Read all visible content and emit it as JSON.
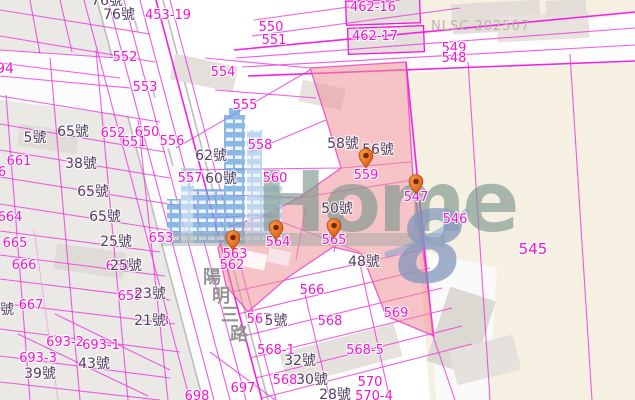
{
  "watermark": {
    "nlsc": "NLSC 202507",
    "logo_text": "Home",
    "logo_numeral": "8"
  },
  "road": {
    "name": "陽明三路"
  },
  "colors": {
    "parcel_label": "#ef16cf",
    "house_label": "#514060",
    "highlight_pink": "#ef9298",
    "boundary_magenta": "#e837dd",
    "pin_orange": "#e05c12",
    "watermark_green": "#7d978e",
    "watermark_blue": "#7e93bb",
    "cream_parcel": "#f6f0e2"
  },
  "map": {
    "parcel_labels": [
      {
        "text": "453-19",
        "x": 168,
        "y": 19
      },
      {
        "text": "550",
        "x": 271,
        "y": 31
      },
      {
        "text": "551",
        "x": 274,
        "y": 44
      },
      {
        "text": "462-16",
        "x": 373,
        "y": 11
      },
      {
        "text": "462-17",
        "x": 375,
        "y": 40
      },
      {
        "text": "549",
        "x": 454,
        "y": 52
      },
      {
        "text": "548",
        "x": 454,
        "y": 62
      },
      {
        "text": "552",
        "x": 125,
        "y": 61
      },
      {
        "text": "553",
        "x": 145,
        "y": 91
      },
      {
        "text": "554",
        "x": 223,
        "y": 76
      },
      {
        "text": "555",
        "x": 245,
        "y": 109
      },
      {
        "text": "556",
        "x": 172,
        "y": 145
      },
      {
        "text": "557",
        "x": 190,
        "y": 182
      },
      {
        "text": "558",
        "x": 260,
        "y": 149
      },
      {
        "text": "560",
        "x": 275,
        "y": 182
      },
      {
        "text": "559",
        "x": 366,
        "y": 179
      },
      {
        "text": "547",
        "x": 416,
        "y": 201
      },
      {
        "text": "546",
        "x": 455,
        "y": 223
      },
      {
        "text": "545",
        "x": 533,
        "y": 254,
        "size": 15
      },
      {
        "text": "562",
        "x": 232,
        "y": 269
      },
      {
        "text": "563",
        "x": 235,
        "y": 258
      },
      {
        "text": "564",
        "x": 278,
        "y": 246
      },
      {
        "text": "565",
        "x": 334,
        "y": 244
      },
      {
        "text": "566",
        "x": 312,
        "y": 294
      },
      {
        "text": "567",
        "x": 259,
        "y": 323
      },
      {
        "text": "568",
        "x": 330,
        "y": 325
      },
      {
        "text": "569",
        "x": 396,
        "y": 317
      },
      {
        "text": "568-1",
        "x": 276,
        "y": 354
      },
      {
        "text": "568-5",
        "x": 365,
        "y": 354
      },
      {
        "text": "568",
        "x": 285,
        "y": 384
      },
      {
        "text": "570",
        "x": 370,
        "y": 386
      },
      {
        "text": "570-4",
        "x": 374,
        "y": 400
      },
      {
        "text": "697",
        "x": 243,
        "y": 392
      },
      {
        "text": "698",
        "x": 197,
        "y": 400
      },
      {
        "text": "693-2",
        "x": 65,
        "y": 346
      },
      {
        "text": "693-1",
        "x": 101,
        "y": 349
      },
      {
        "text": "693-3",
        "x": 38,
        "y": 362
      },
      {
        "text": "650",
        "x": 147,
        "y": 136
      },
      {
        "text": "651",
        "x": 134,
        "y": 146
      },
      {
        "text": "652",
        "x": 113,
        "y": 137
      },
      {
        "text": "653",
        "x": 161,
        "y": 242
      },
      {
        "text": "654",
        "x": 118,
        "y": 270
      },
      {
        "text": "655",
        "x": 130,
        "y": 300
      },
      {
        "text": "661",
        "x": 19,
        "y": 165
      },
      {
        "text": "664",
        "x": 10,
        "y": 221
      },
      {
        "text": "665",
        "x": 15,
        "y": 247
      },
      {
        "text": "666",
        "x": 24,
        "y": 269
      },
      {
        "text": "667",
        "x": 31,
        "y": 309
      },
      {
        "text": "94",
        "x": 5,
        "y": 73,
        "size": 14
      },
      {
        "text": "6",
        "x": 2,
        "y": 176
      },
      {
        "text": "3",
        "x": 165,
        "y": 325
      }
    ],
    "house_labels": [
      {
        "text": "76號",
        "x": 107,
        "y": 5
      },
      {
        "text": "76號",
        "x": 119,
        "y": 19
      },
      {
        "text": "5號",
        "x": 35,
        "y": 142
      },
      {
        "text": "65號",
        "x": 73,
        "y": 136
      },
      {
        "text": "38號",
        "x": 81,
        "y": 168
      },
      {
        "text": "65號",
        "x": 93,
        "y": 196
      },
      {
        "text": "65號",
        "x": 105,
        "y": 221
      },
      {
        "text": "25號",
        "x": 116,
        "y": 246
      },
      {
        "text": "25號",
        "x": 126,
        "y": 270
      },
      {
        "text": "23號",
        "x": 150,
        "y": 298
      },
      {
        "text": "21號",
        "x": 150,
        "y": 325
      },
      {
        "text": "43號",
        "x": 94,
        "y": 368
      },
      {
        "text": "39號",
        "x": 40,
        "y": 378
      },
      {
        "text": "62號",
        "x": 211,
        "y": 160
      },
      {
        "text": "60號",
        "x": 221,
        "y": 183
      },
      {
        "text": "58號",
        "x": 343,
        "y": 148
      },
      {
        "text": "56號",
        "x": 378,
        "y": 154
      },
      {
        "text": "50號",
        "x": 337,
        "y": 213
      },
      {
        "text": "48號",
        "x": 364,
        "y": 266
      },
      {
        "text": "5號",
        "x": 276,
        "y": 325
      },
      {
        "text": "32號",
        "x": 300,
        "y": 365
      },
      {
        "text": "30號",
        "x": 312,
        "y": 384
      },
      {
        "text": "28號",
        "x": 335,
        "y": 399
      },
      {
        "text": "號",
        "x": 7,
        "y": 314
      }
    ],
    "pins": [
      {
        "x": 366,
        "y": 168
      },
      {
        "x": 416,
        "y": 194
      },
      {
        "x": 233,
        "y": 250
      },
      {
        "x": 276,
        "y": 240
      },
      {
        "x": 334,
        "y": 238
      }
    ]
  }
}
